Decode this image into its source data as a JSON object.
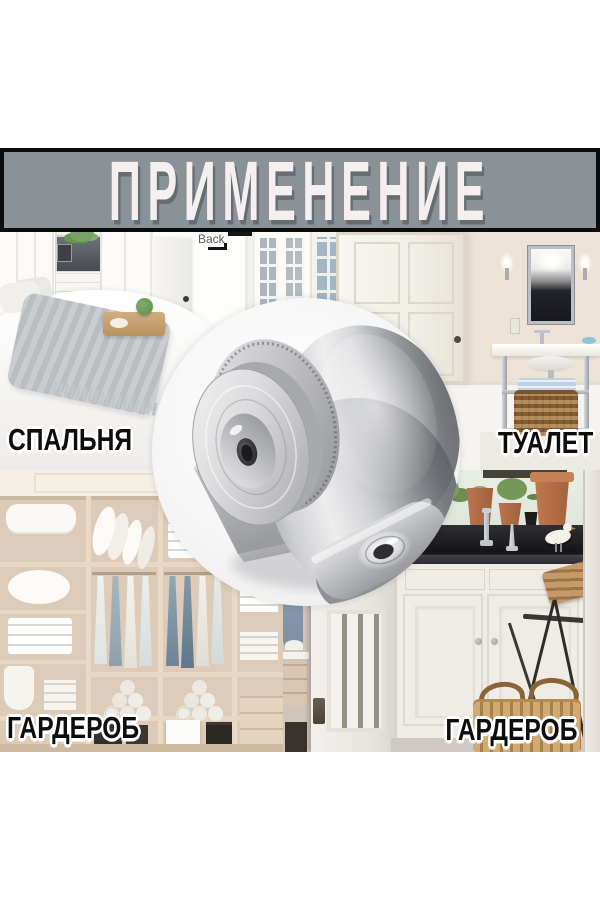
{
  "banner": {
    "title": "ПРИМЕНЕНИЕ",
    "bg_color": "#8a9297",
    "text_color": "#f5efef",
    "border_color": "#0c0c0c"
  },
  "sections": {
    "bedroom": {
      "label": "СПАЛЬНЯ",
      "door_sign": "Back"
    },
    "toilet": {
      "label": "ТУАЛЕТ"
    },
    "wardrobe": {
      "label": "ГАРДЕРОБ"
    },
    "kitchen": {
      "label": "ГАРДЕРОБ"
    }
  },
  "product": {
    "kind_icon": "magnetic-door-stopper",
    "metal_light": "#ededee",
    "metal_mid": "#c6c7ca",
    "metal_dark": "#95979b"
  },
  "label_style": {
    "text_color": "#0d0d0d",
    "outline_color": "#ffffff"
  }
}
